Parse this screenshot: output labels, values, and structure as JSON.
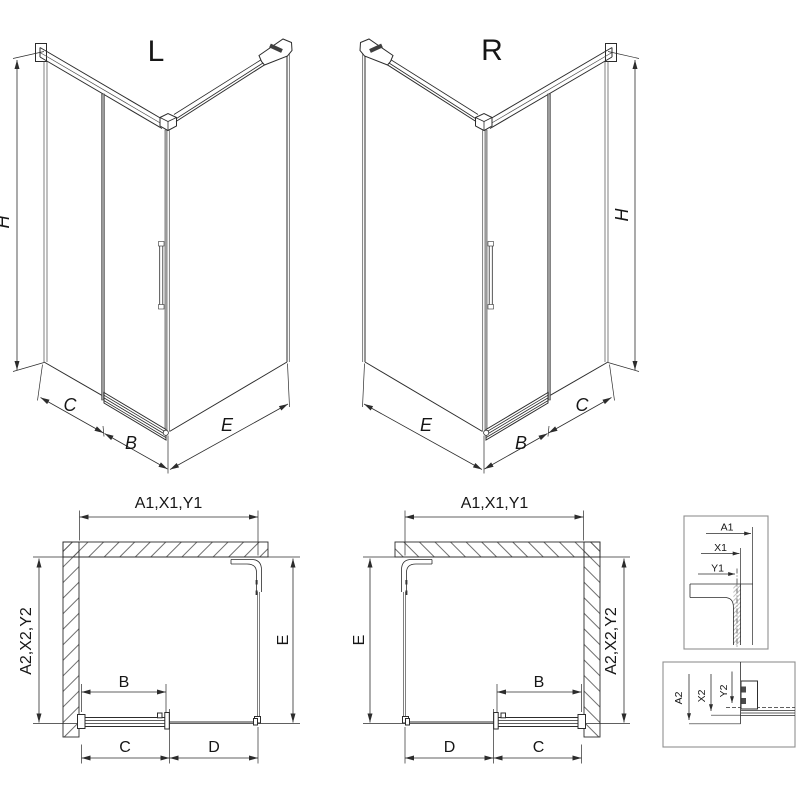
{
  "views": {
    "perspective_left": {
      "title": "L",
      "dim_height": "H",
      "dim_fixed": "C",
      "dim_door": "B",
      "dim_side": "E"
    },
    "perspective_right": {
      "title": "R",
      "dim_height": "H",
      "dim_fixed": "C",
      "dim_door": "B",
      "dim_side": "E"
    },
    "plan_left": {
      "dim_width_top": "A1,X1,Y1",
      "dim_depth_side": "A2,X2,Y2",
      "dim_door": "B",
      "dim_c": "C",
      "dim_d": "D",
      "dim_side": "E"
    },
    "plan_right": {
      "dim_width_top": "A1,X1,Y1",
      "dim_depth_side": "A2,X2,Y2",
      "dim_door": "B",
      "dim_c": "C",
      "dim_d": "D",
      "dim_side": "E"
    },
    "detail_width_refs": {
      "a1": "A1",
      "x1": "X1",
      "y1": "Y1"
    },
    "detail_depth_refs": {
      "a2": "A2",
      "x2": "X2",
      "y2": "Y2"
    }
  },
  "colors": {
    "line": "#2c2c2c",
    "glass": "#8f8f8f",
    "background": "#ffffff"
  }
}
